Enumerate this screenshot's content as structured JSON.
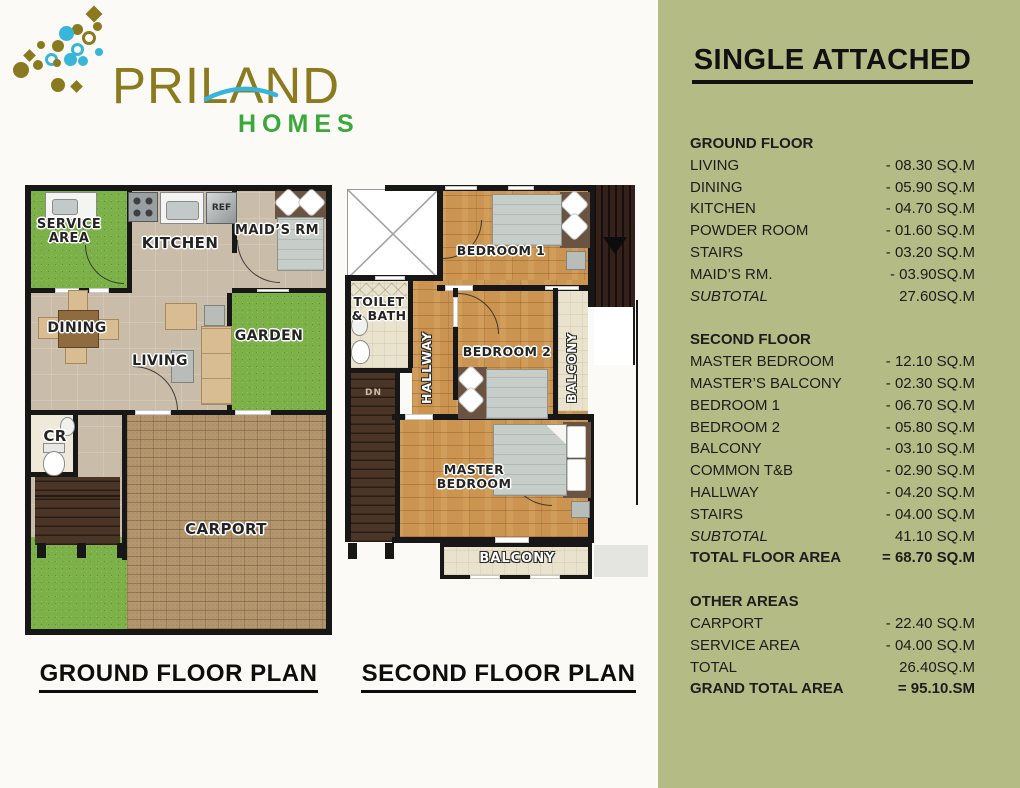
{
  "logo": {
    "brand": "PRILAND",
    "tagline": "HOMES"
  },
  "ground_plan": {
    "title": "GROUND FLOOR PLAN",
    "labels": {
      "service_area": "SERVICE AREA",
      "kitchen": "KITCHEN",
      "ref": "REF",
      "maids_rm": "MAID’S RM",
      "dining": "DINING",
      "living": "LIVING",
      "garden": "GARDEN",
      "cr": "CR",
      "carport": "CARPORT"
    }
  },
  "second_plan": {
    "title": "SECOND FLOOR PLAN",
    "labels": {
      "bedroom1": "BEDROOM 1",
      "toilet_bath": "TOILET & BATH",
      "hallway": "HALLWAY",
      "bedroom2": "BEDROOM 2",
      "balcony_side": "BALCONY",
      "master_bedroom": "MASTER BEDROOM",
      "balcony_bottom": "BALCONY",
      "down": "DN"
    }
  },
  "sidebar": {
    "title": "SINGLE ATTACHED",
    "sections": [
      {
        "header": "GROUND FLOOR",
        "rows": [
          {
            "label": "LIVING",
            "value": "- 08.30 SQ.M"
          },
          {
            "label": "DINING",
            "value": "- 05.90 SQ.M"
          },
          {
            "label": "KITCHEN",
            "value": "- 04.70 SQ.M"
          },
          {
            "label": "POWDER ROOM",
            "value": "- 01.60 SQ.M"
          },
          {
            "label": "STAIRS",
            "value": "- 03.20 SQ.M"
          },
          {
            "label": "MAID’S RM.",
            "value": "- 03.90SQ.M"
          },
          {
            "label": "SUBTOTAL",
            "value": "27.60SQ.M",
            "style": "italic"
          }
        ]
      },
      {
        "header": "SECOND FLOOR",
        "rows": [
          {
            "label": "MASTER BEDROOM",
            "value": "- 12.10 SQ.M"
          },
          {
            "label": "MASTER’S BALCONY",
            "value": "- 02.30 SQ.M"
          },
          {
            "label": "BEDROOM 1",
            "value": "- 06.70 SQ.M"
          },
          {
            "label": "BEDROOM 2",
            "value": "- 05.80 SQ.M"
          },
          {
            "label": "BALCONY",
            "value": "- 03.10 SQ.M"
          },
          {
            "label": "COMMON T&B",
            "value": "- 02.90 SQ.M"
          },
          {
            "label": "HALLWAY",
            "value": "- 04.20 SQ.M"
          },
          {
            "label": "STAIRS",
            "value": "- 04.00 SQ.M"
          },
          {
            "label": "SUBTOTAL",
            "value": "41.10 SQ.M",
            "style": "italic"
          },
          {
            "label": "TOTAL FLOOR AREA",
            "value": "= 68.70 SQ.M",
            "style": "bold"
          }
        ]
      },
      {
        "header": "OTHER AREAS",
        "rows": [
          {
            "label": "CARPORT",
            "value": "- 22.40 SQ.M"
          },
          {
            "label": "SERVICE AREA",
            "value": "- 04.00 SQ.M"
          },
          {
            "label": "TOTAL",
            "value": "26.40SQ.M"
          },
          {
            "label": "GRAND TOTAL AREA",
            "value": "= 95.10.SM",
            "style": "bold"
          }
        ]
      }
    ]
  },
  "colors": {
    "sidebar_bg": "#b5bb85",
    "page_bg": "#fbfaf6",
    "wall": "#171717",
    "brand_gold": "#8b7a1e",
    "brand_blue": "#35b4dc",
    "brand_green": "#3aa83a",
    "grass": "#7cb14a",
    "wood_floor": "#cb9450",
    "brick": "#b3966d"
  }
}
